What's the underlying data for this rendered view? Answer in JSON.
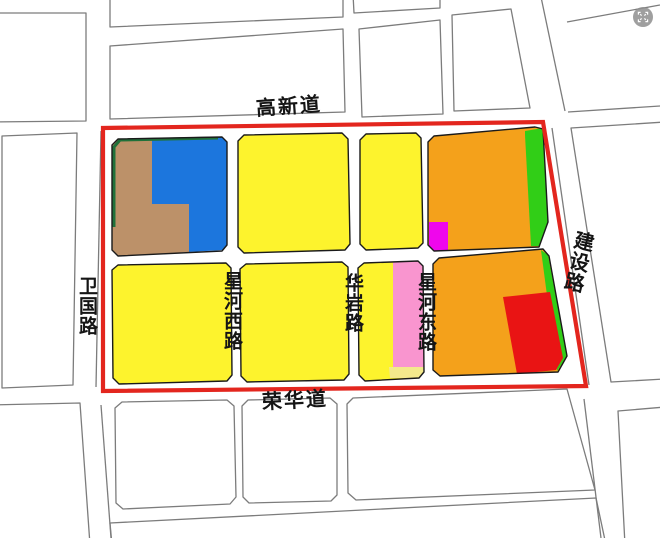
{
  "map": {
    "road_labels": {
      "top": "高新道",
      "bottom": "荣华道",
      "left": "卫国路",
      "right": "建设路",
      "inner_west": "星河西路",
      "inner_center": "华岩路",
      "inner_east": "星河东路"
    },
    "colors": {
      "background": "#FFFFFF",
      "road_line": "#7C7C7C",
      "block_outline": "#1A1A1A",
      "boundary_red": "#E3261E",
      "yellow": "#FDF32D",
      "orange": "#F4A11B",
      "blue": "#1C76DD",
      "brown": "#BC9169",
      "bright_green": "#31CE17",
      "dark_green": "#20713A",
      "magenta": "#EF06EC",
      "pink": "#F995CF",
      "pale_yellow": "#F4E98C",
      "red_parcel": "#E91414"
    }
  },
  "watermark": {
    "icon": "fullscreen-icon",
    "bg": "#8F8F8F",
    "fg": "#FFFFFF"
  }
}
